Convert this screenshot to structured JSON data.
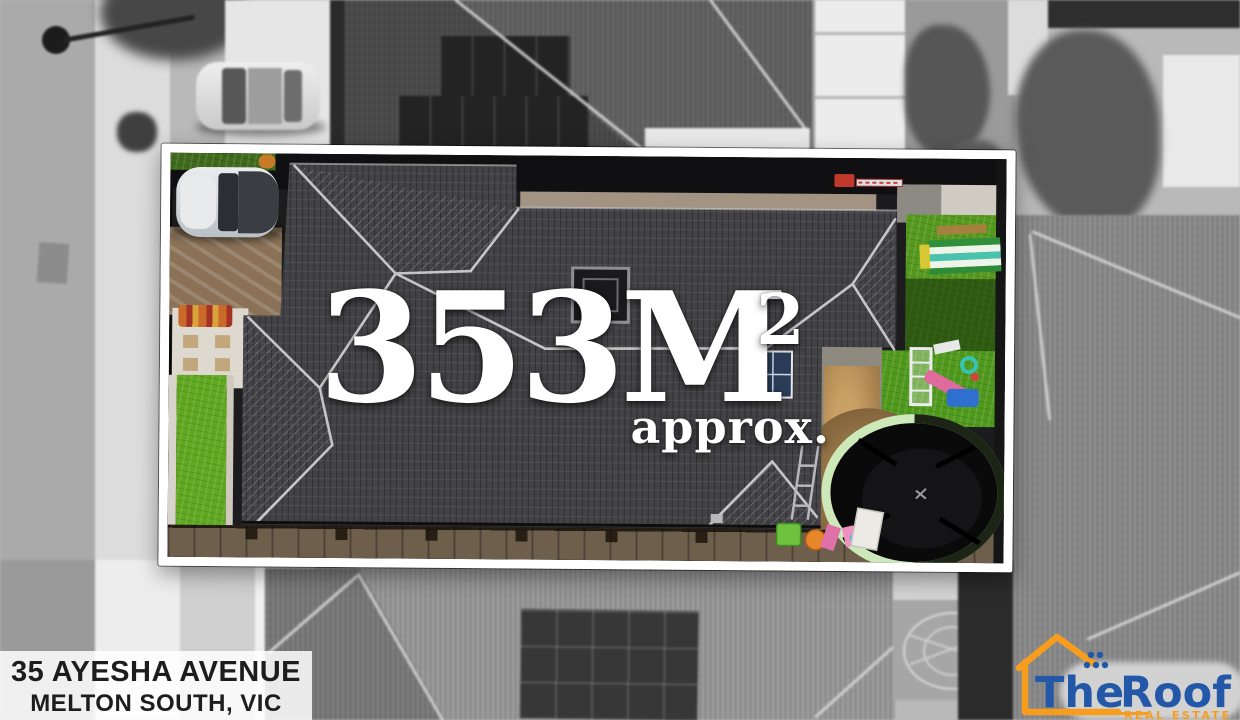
{
  "overlay": {
    "area_value": "353M",
    "area_unit_superscript": "2",
    "area_qualifier": "approx."
  },
  "address": {
    "line1": "35 AYESHA AVENUE",
    "line2": "MELTON SOUTH, VIC"
  },
  "logo": {
    "brand_word1": "The",
    "brand_word2": "Roof",
    "tagline": "REAL ESTATE"
  },
  "colors": {
    "boundary_border": "#ffffff",
    "overlay_text": "#ffffff",
    "address_text": "#1d1d1d",
    "address_background": "rgba(255,255,255,0.85)",
    "logo_blue": "#2358a8",
    "logo_orange": "#f79d1e",
    "roof_tiles": "#434347",
    "front_lawn_green": "#5fa81f",
    "backyard_turf_green": "#55991e",
    "driveway_tan": "#8b7257",
    "trampoline_rim": "#cde9ba"
  },
  "scene": {
    "objects": [
      "street",
      "footpath",
      "street-light",
      "parked-car-on-street",
      "neighbor-roof-top",
      "neighbor-solar-panels",
      "white-garage",
      "trees",
      "property-boundary-highlight",
      "hedge",
      "parked-car-in-driveway",
      "driveway",
      "doormat",
      "stepping-stones",
      "front-lawn",
      "house-hip-roof",
      "skylight",
      "solar-panel",
      "red-trailer",
      "backyard-turf",
      "striped-swing",
      "kids-playset",
      "trampoline",
      "patio",
      "sand-area",
      "toys",
      "timber-deck-fence",
      "neighbor-roof-bottom",
      "solar-array-bottom",
      "patio-furniture",
      "dome-climber",
      "neighbor-roof-right"
    ]
  }
}
